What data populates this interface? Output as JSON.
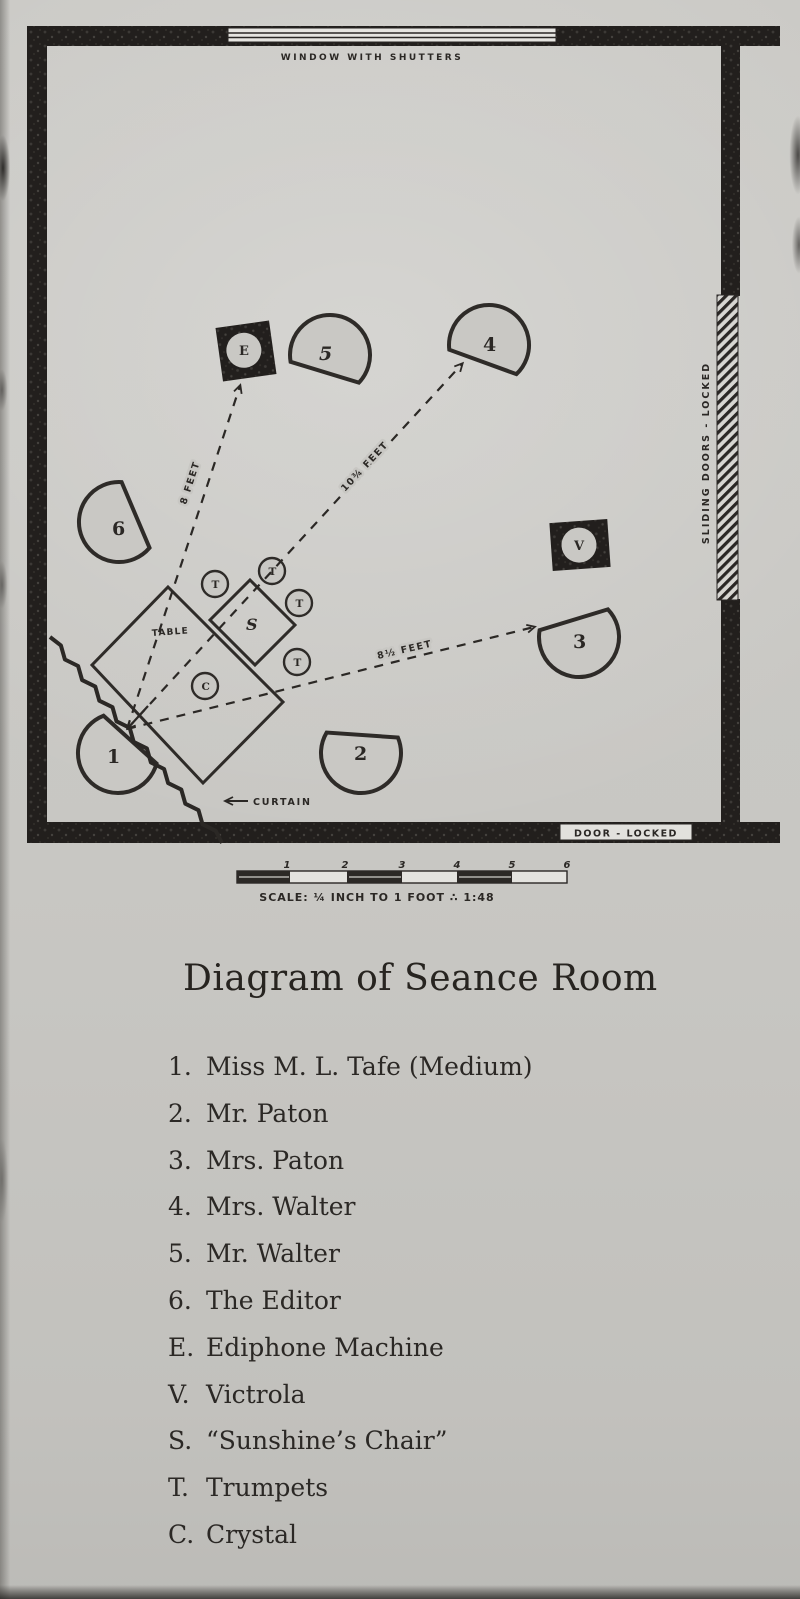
{
  "title": "Diagram of Seance Room",
  "diagram": {
    "window_label": "WINDOW WITH SHUTTERS",
    "sliding_doors_label": "SLIDING DOORS - LOCKED",
    "door_label": "DOOR - LOCKED",
    "curtain_label": "CURTAIN",
    "table_label": "TABLE",
    "chairs": [
      "1",
      "2",
      "3",
      "4",
      "5",
      "6"
    ],
    "equipment": {
      "ediphone": "E",
      "victrola": "V",
      "sunshine_chair": "S",
      "trumpet": "T",
      "crystal": "C"
    },
    "measurements": {
      "to_ediphone": "8 FEET",
      "to_chair4": "10¾ FEET",
      "to_chair3": "8½ FEET"
    },
    "scale_bar": {
      "ticks": [
        "1",
        "2",
        "3",
        "4",
        "5",
        "6"
      ],
      "caption": "SCALE: ¼ INCH TO 1 FOOT ∴ 1:48"
    }
  },
  "legend": [
    {
      "key": "1.",
      "label": "Miss M. L. Tafe (Medium)"
    },
    {
      "key": "2.",
      "label": "Mr. Paton"
    },
    {
      "key": "3.",
      "label": "Mrs. Paton"
    },
    {
      "key": "4.",
      "label": "Mrs. Walter"
    },
    {
      "key": "5.",
      "label": "Mr. Walter"
    },
    {
      "key": "6.",
      "label": "The Editor"
    },
    {
      "key": "E.",
      "label": "Ediphone Machine"
    },
    {
      "key": "V.",
      "label": "Victrola"
    },
    {
      "key": "S.",
      "label": "“Sunshine’s Chair”"
    },
    {
      "key": "T.",
      "label": "Trumpets"
    },
    {
      "key": "C.",
      "label": "Crystal"
    }
  ]
}
